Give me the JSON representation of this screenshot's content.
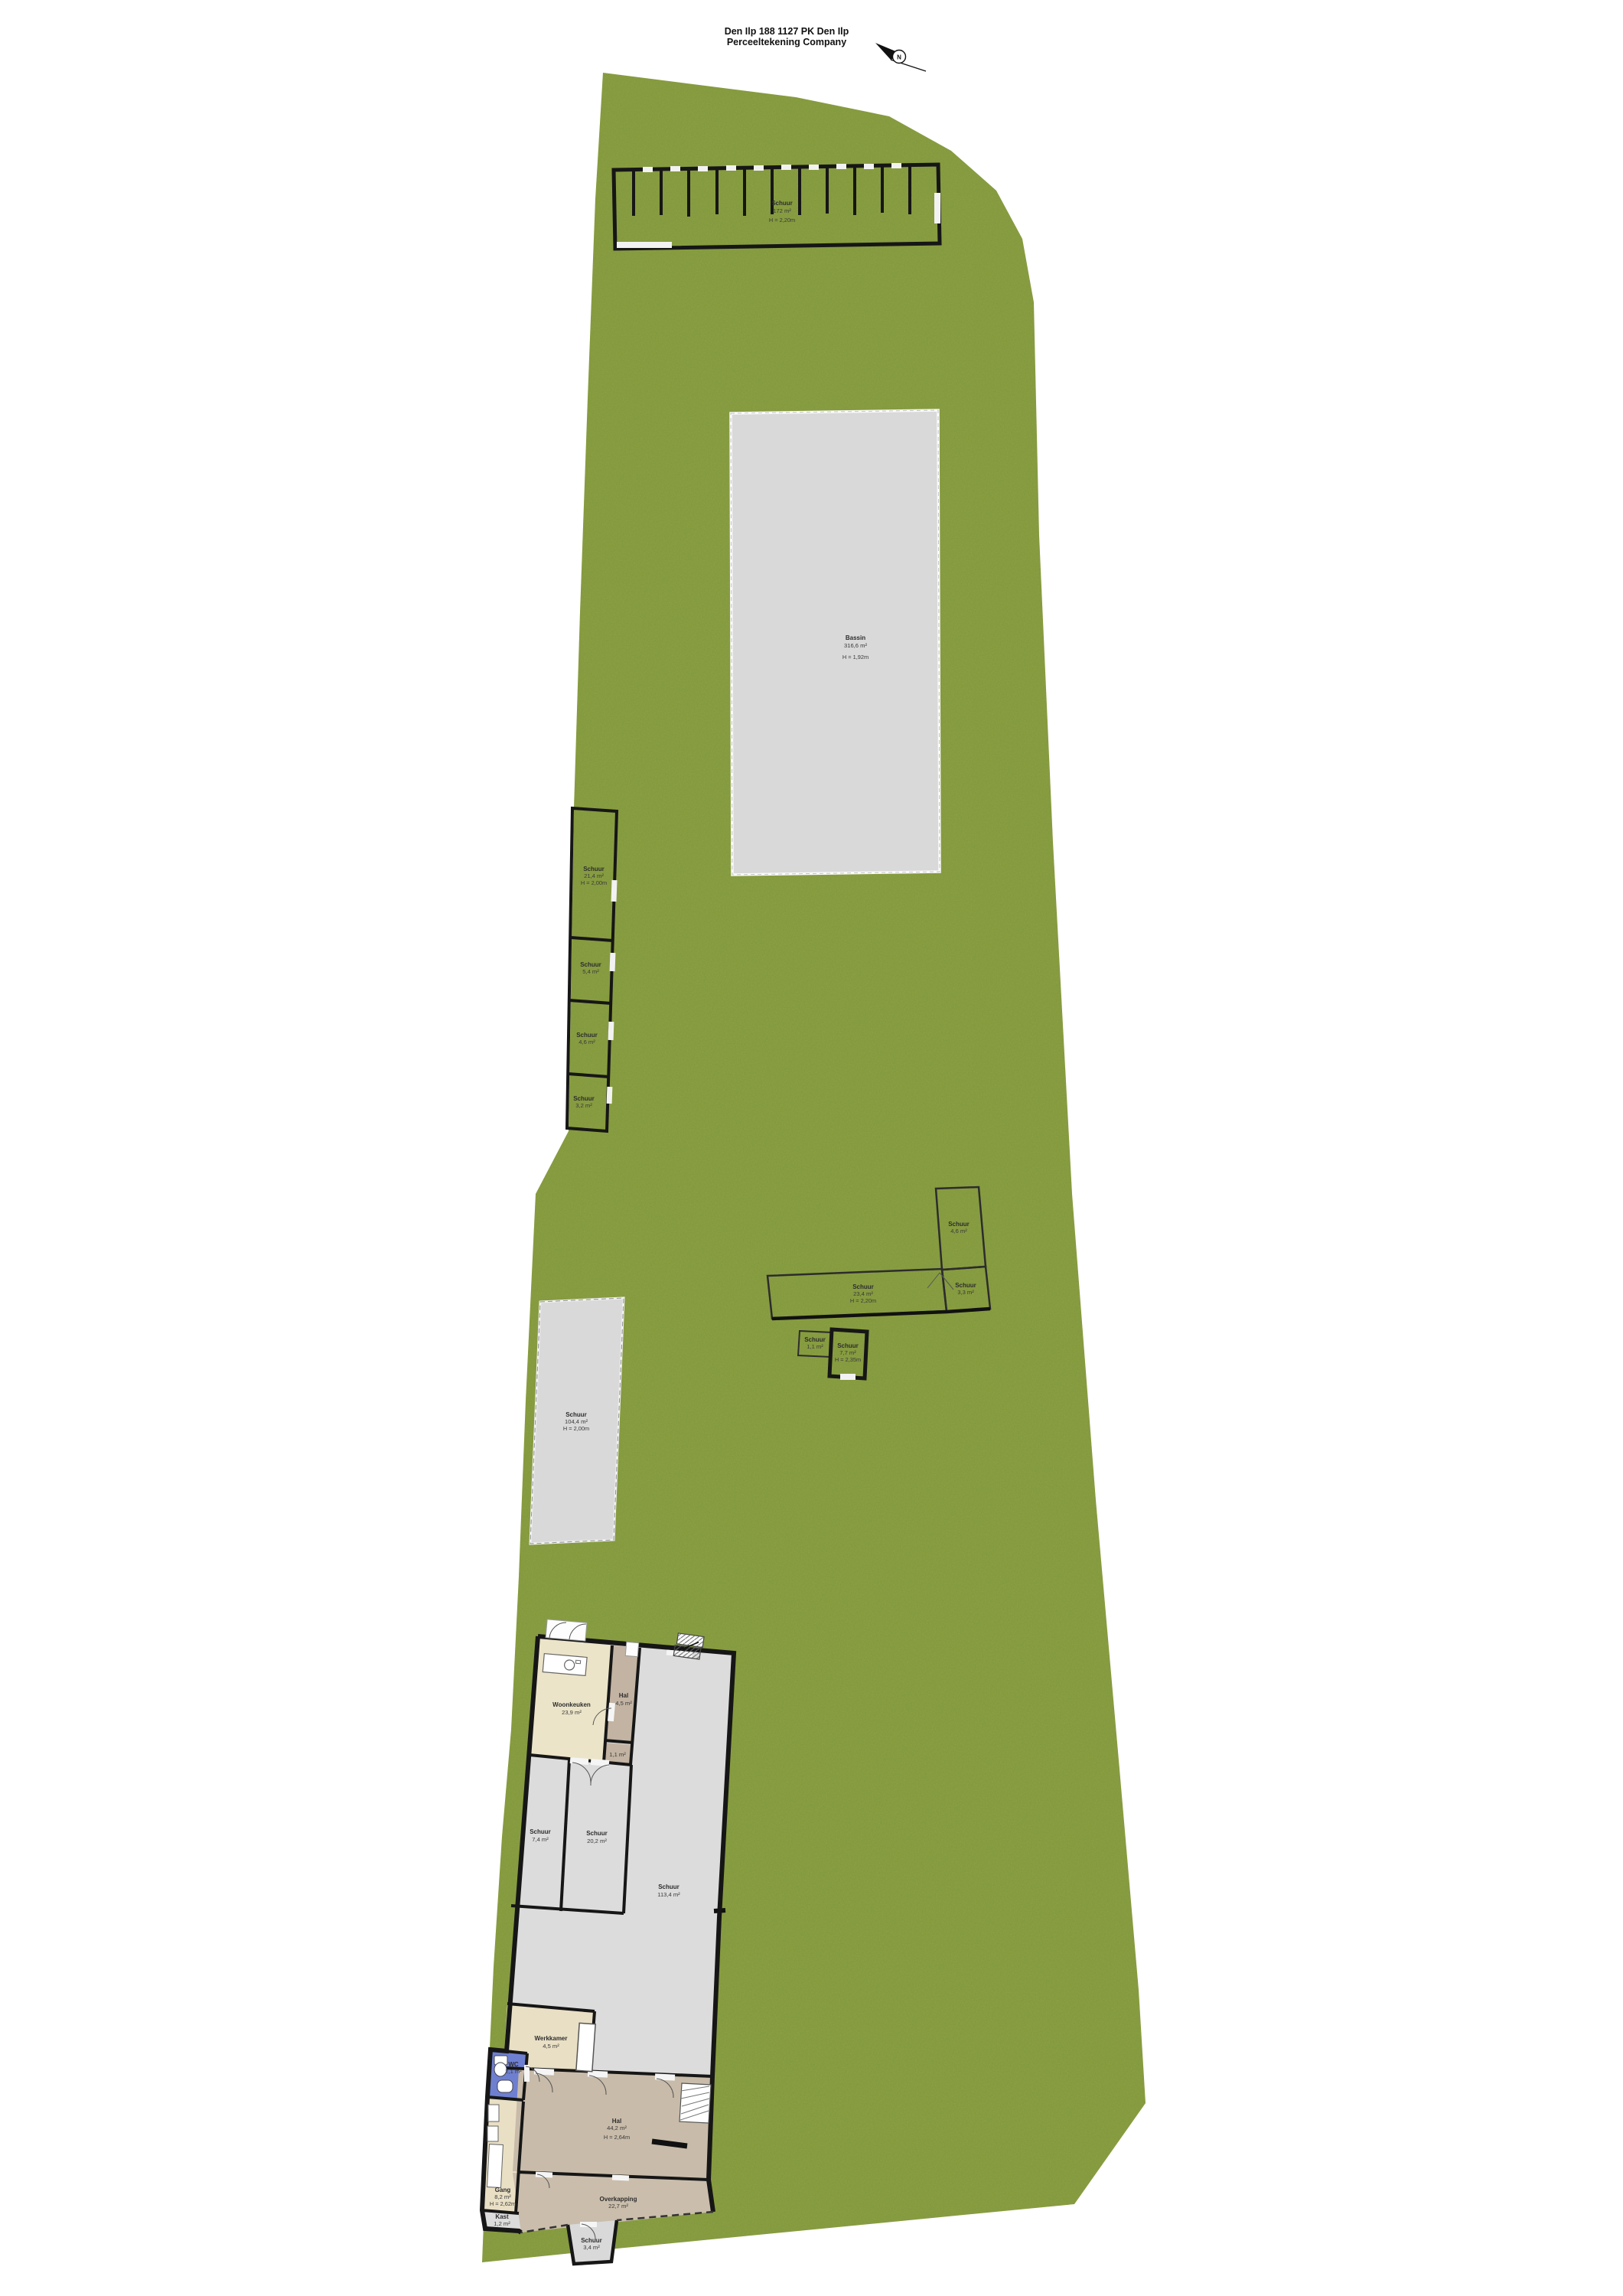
{
  "title": {
    "line1": "Den Ilp 188 1127 PK Den Ilp",
    "line2": "Perceeltekening Company"
  },
  "compass": {
    "north_label": "N"
  },
  "colors": {
    "grass": "#8ba143",
    "building_gray": "#dbdbdb",
    "beige": "#ece4c8",
    "taupe": "#c2b3a2",
    "tan": "#c8bba9",
    "wc_blue": "#6f7fd0",
    "wall_black": "#161616"
  },
  "labels": {
    "shed_top": {
      "name": "Schuur",
      "area": "172 m²",
      "height": "H = 2,20m"
    },
    "basin": {
      "name": "Bassin",
      "area": "316,6 m²",
      "height": "H = 1,92m"
    },
    "room_a": {
      "name": "Schuur",
      "area": "21,4 m²",
      "height": "H = 2,00m"
    },
    "room_b": {
      "name": "Schuur",
      "area": "5,4 m²"
    },
    "room_c": {
      "name": "Schuur",
      "area": "4,6 m²"
    },
    "room_d": {
      "name": "Schuur",
      "area": "3,2 m²"
    },
    "shed_long": {
      "name": "Schuur",
      "area": "104,4 m²",
      "height": "H = 2,00m"
    },
    "l_wing": {
      "name": "Schuur",
      "area": "4,6 m²"
    },
    "l_corner": {
      "name": "Schuur",
      "area": "3,3 m²"
    },
    "l_arm": {
      "name": "Schuur",
      "area": "23,4 m²",
      "height": "H = 2,20m"
    },
    "hut": {
      "name": "Schuur",
      "area": "7,7 m²",
      "height": "H = 2,35m"
    },
    "hut_small": {
      "name": "Schuur",
      "area": "1,1 m²"
    },
    "woonkeuken": {
      "name": "Woonkeuken",
      "area": "23,9 m²"
    },
    "hal_top": {
      "name": "Hal",
      "area": "4,5 m²"
    },
    "hal_small": {
      "name": "Hal",
      "area": "1,1 m²"
    },
    "schuur_left": {
      "name": "Schuur",
      "area": "7,4 m²"
    },
    "schuur_mid": {
      "name": "Schuur",
      "area": "20,2 m²"
    },
    "schuur_big": {
      "name": "Schuur",
      "area": "113,4 m²"
    },
    "werkkamer": {
      "name": "Werkkamer",
      "area": "4,5 m²"
    },
    "wc": {
      "name": "WC",
      "area": "2,1 m²"
    },
    "gang": {
      "name": "Gang",
      "area": "8,2 m²",
      "height": "H = 2,62m"
    },
    "kast": {
      "name": "Kast",
      "area": "1,2 m²"
    },
    "hal_main": {
      "name": "Hal",
      "area": "44,2 m²",
      "height": "H = 2,64m"
    },
    "overkapping": {
      "name": "Overkapping",
      "area": "22,7 m²"
    },
    "entree": {
      "name": "Schuur",
      "area": "3,4 m²"
    }
  }
}
